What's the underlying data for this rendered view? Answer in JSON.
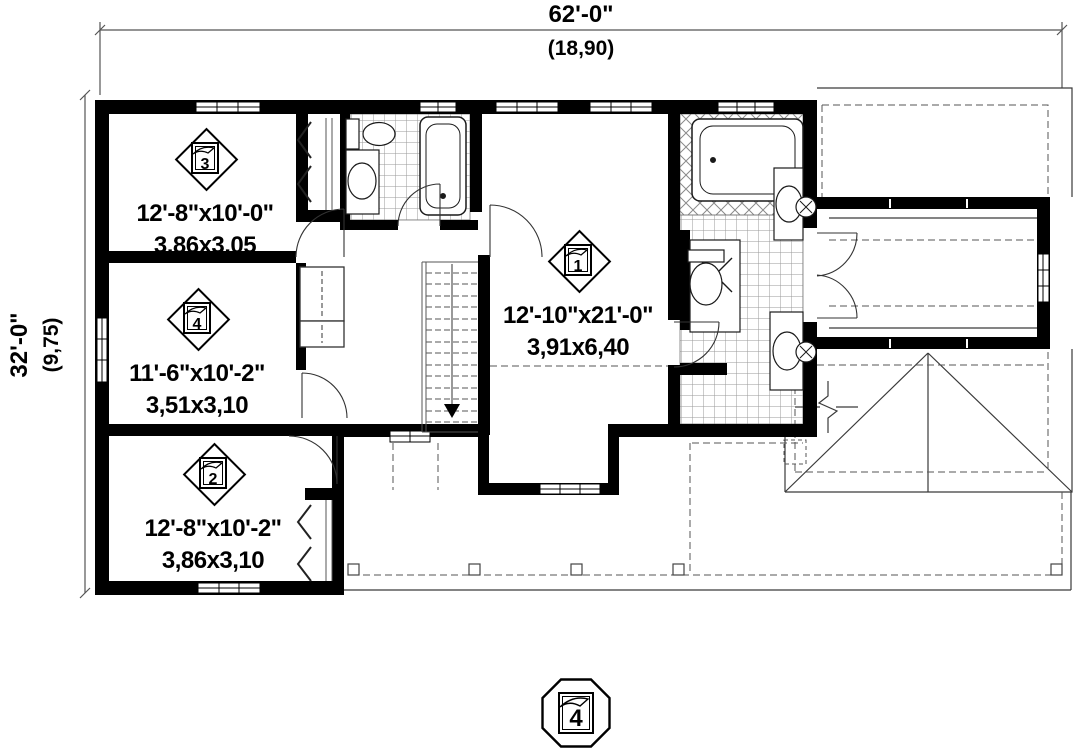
{
  "plan_title": "second-floor-plan",
  "dimensions": {
    "top": {
      "primary": "62'-0\"",
      "secondary": "(18,90)"
    },
    "left": {
      "primary": "32'-0\"",
      "secondary": "(9,75)"
    }
  },
  "rooms": [
    {
      "id": "1",
      "imperial": "12'-10\"x21'-0\"",
      "metric": "3,91x6,40"
    },
    {
      "id": "2",
      "imperial": "12'-8\"x10'-2\"",
      "metric": "3,86x3,10"
    },
    {
      "id": "3",
      "imperial": "12'-8\"x10'-0\"",
      "metric": "3,86x3,05"
    },
    {
      "id": "4",
      "imperial": "11'-6\"x10'-2\"",
      "metric": "3,51x3,10"
    }
  ],
  "floor_badge": {
    "number": "4"
  },
  "colors": {
    "wall": "#000000",
    "line": "#3a3a3a",
    "dashed": "#555555",
    "background": "#ffffff"
  }
}
